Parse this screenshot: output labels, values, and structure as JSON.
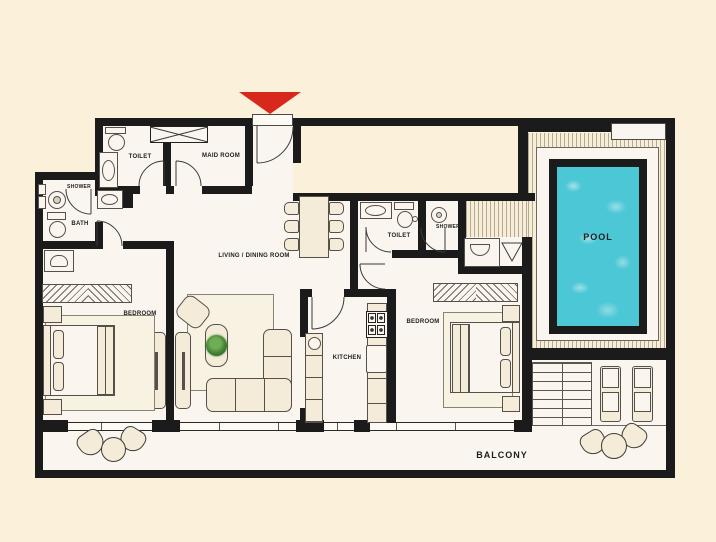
{
  "plan_title": "apartment-floor-plan",
  "rooms": [
    {
      "id": "toilet-1",
      "label": "TOILET"
    },
    {
      "id": "maid-room",
      "label": "MAID ROOM"
    },
    {
      "id": "shower-1",
      "label": "SHOWER"
    },
    {
      "id": "bath",
      "label": "BATH"
    },
    {
      "id": "living-dining",
      "label": "LIVING / DINING ROOM"
    },
    {
      "id": "bedroom-1",
      "label": "BEDROOM"
    },
    {
      "id": "kitchen",
      "label": "KITCHEN"
    },
    {
      "id": "toilet-2",
      "label": "TOILET"
    },
    {
      "id": "shower-2",
      "label": "SHOWER"
    },
    {
      "id": "bedroom-2",
      "label": "BEDROOM"
    },
    {
      "id": "pool",
      "label": "POOL"
    },
    {
      "id": "balcony",
      "label": "BALCONY"
    }
  ],
  "markers": {
    "entrance_arrow": "entrance-direction-marker"
  },
  "colors": {
    "background": "#fbf0da",
    "room_floor": "#faf6ef",
    "wall": "#1b1b1b",
    "furniture": "#f4ecd9",
    "accent_red": "#d7281b",
    "pool_water": "#4cc7d5",
    "plant_green": "#4e8f3c"
  }
}
